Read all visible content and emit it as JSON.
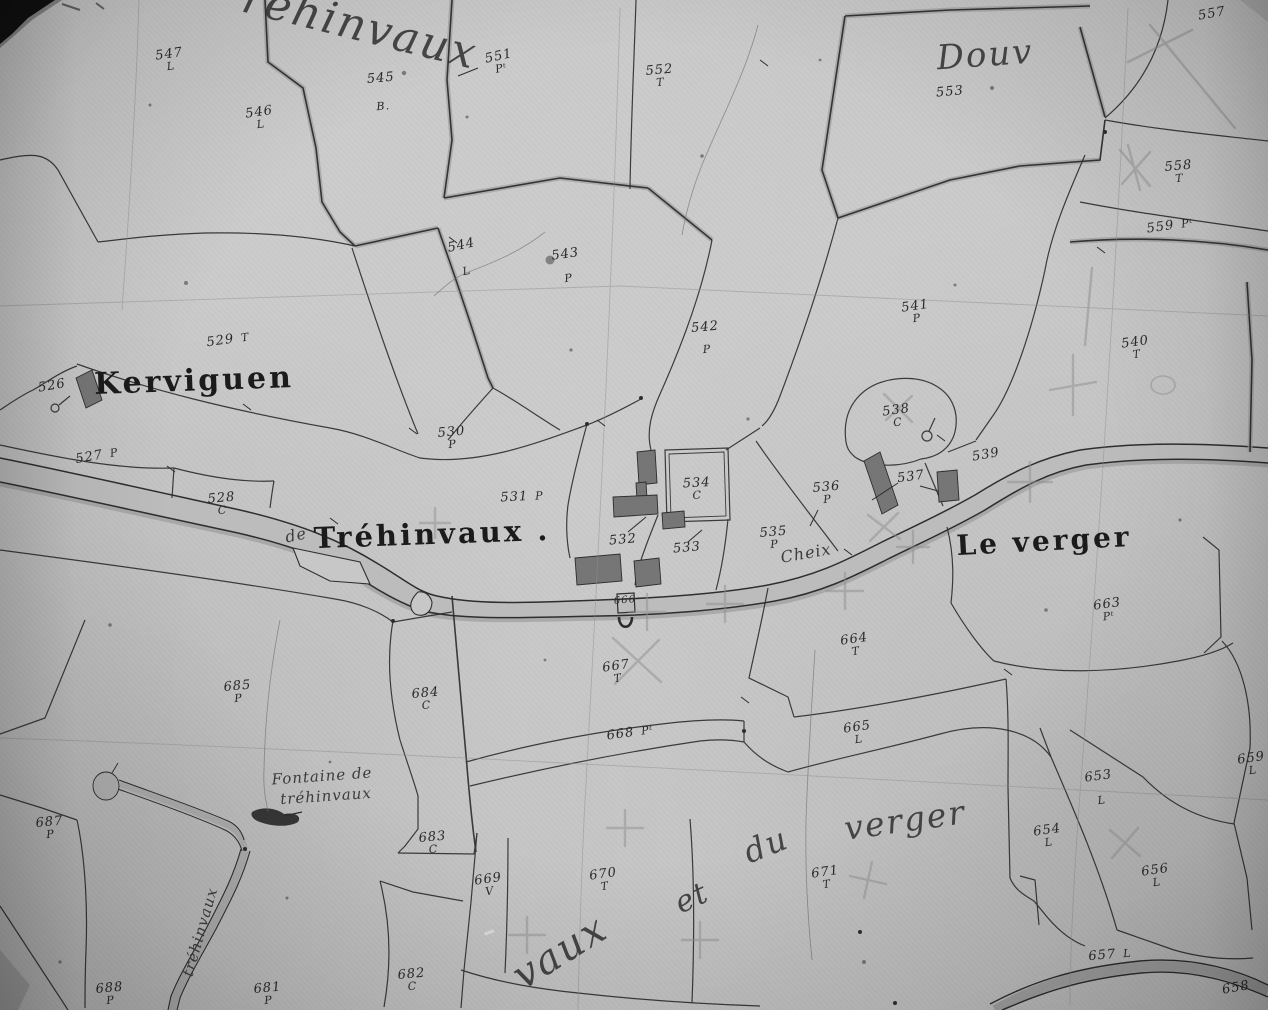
{
  "map": {
    "description_labels": {
      "type": "cadastral-map-scan"
    },
    "colors": {
      "paper": "#c7c7c7",
      "ink": "#2e2e2e",
      "boundary_shade": "#a2a2a2",
      "building_fill": "#767676",
      "road_fill": "#bcbcbc",
      "pencil": "#8f8f8f",
      "photo_corner": "#111111"
    },
    "places": [
      {
        "text": "Kerviguen",
        "x": 194,
        "y": 381,
        "size": 30,
        "rot": -2,
        "style": "bold"
      },
      {
        "text": "Tréhinvaux .",
        "x": 432,
        "y": 534,
        "size": 29,
        "rot": -2,
        "style": "bold"
      },
      {
        "text": "Le verger",
        "x": 1044,
        "y": 541,
        "size": 28,
        "rot": -3,
        "style": "bold"
      },
      {
        "text": "Douv",
        "x": 985,
        "y": 55,
        "size": 34,
        "rot": -4,
        "style": "script-big"
      },
      {
        "text": "réhinvaux",
        "x": 360,
        "y": 26,
        "size": 44,
        "rot": 14,
        "style": "script-big"
      },
      {
        "text": "Cheix",
        "x": 806,
        "y": 553,
        "size": 16,
        "rot": -10,
        "style": "script"
      },
      {
        "text": "Fontaine de",
        "x": 322,
        "y": 776,
        "size": 15,
        "rot": -4,
        "style": "script"
      },
      {
        "text": "tréhinvaux",
        "x": 326,
        "y": 796,
        "size": 15,
        "rot": -4,
        "style": "script"
      },
      {
        "text": "de",
        "x": 296,
        "y": 535,
        "size": 16,
        "rot": -12,
        "style": "script"
      },
      {
        "text": "vaux",
        "x": 560,
        "y": 952,
        "size": 40,
        "rot": -32,
        "style": "script-big"
      },
      {
        "text": "et",
        "x": 692,
        "y": 898,
        "size": 30,
        "rot": -25,
        "style": "script-big"
      },
      {
        "text": "du",
        "x": 766,
        "y": 845,
        "size": 32,
        "rot": -22,
        "style": "script-big"
      },
      {
        "text": "verger",
        "x": 905,
        "y": 820,
        "size": 33,
        "rot": -8,
        "style": "script-big"
      },
      {
        "text": "tréhinvaux",
        "x": 200,
        "y": 932,
        "size": 15,
        "rot": -74,
        "style": "script"
      }
    ],
    "parcels": [
      {
        "num": "547",
        "cls": "L",
        "x": 170,
        "y": 60,
        "rot": -8
      },
      {
        "num": "546",
        "cls": "L",
        "x": 260,
        "y": 118,
        "rot": -8
      },
      {
        "num": "545",
        "cls": "B.",
        "x": 382,
        "y": 92,
        "rot": -5,
        "gap": 16
      },
      {
        "num": "551",
        "cls": "Pᵗ",
        "x": 500,
        "y": 62,
        "rot": -12
      },
      {
        "num": "552",
        "cls": "T",
        "x": 660,
        "y": 76,
        "rot": -5
      },
      {
        "num": "553",
        "cls": "",
        "x": 950,
        "y": 92,
        "rot": -5
      },
      {
        "num": "557",
        "cls": "",
        "x": 1212,
        "y": 14,
        "rot": -10
      },
      {
        "num": "558",
        "cls": "T",
        "x": 1179,
        "y": 172,
        "rot": -5
      },
      {
        "num": "559",
        "cls": "Pᵗ",
        "x": 1170,
        "y": 226,
        "rot": -8,
        "inline": true
      },
      {
        "num": "544",
        "cls": "L",
        "x": 464,
        "y": 258,
        "rot": -12,
        "gap": 14
      },
      {
        "num": "543",
        "cls": "P",
        "x": 567,
        "y": 266,
        "rot": -8,
        "gap": 12
      },
      {
        "num": "542",
        "cls": "P",
        "x": 706,
        "y": 338,
        "rot": -5,
        "gap": 10
      },
      {
        "num": "541",
        "cls": "P",
        "x": 916,
        "y": 312,
        "rot": -8
      },
      {
        "num": "540",
        "cls": "T",
        "x": 1136,
        "y": 348,
        "rot": -8
      },
      {
        "num": "529",
        "cls": "T",
        "x": 228,
        "y": 340,
        "rot": -8,
        "inline": true
      },
      {
        "num": "526",
        "cls": "",
        "x": 52,
        "y": 386,
        "rot": -10
      },
      {
        "num": "527",
        "cls": "P",
        "x": 97,
        "y": 456,
        "rot": -10,
        "inline": true
      },
      {
        "num": "528",
        "cls": "C",
        "x": 222,
        "y": 504,
        "rot": -5
      },
      {
        "num": "530",
        "cls": "P",
        "x": 452,
        "y": 438,
        "rot": -5
      },
      {
        "num": "531",
        "cls": "P",
        "x": 522,
        "y": 497,
        "rot": -3,
        "inline": true
      },
      {
        "num": "534",
        "cls": "C",
        "x": 697,
        "y": 489,
        "rot": -3
      },
      {
        "num": "532",
        "cls": "",
        "x": 623,
        "y": 540,
        "rot": -5
      },
      {
        "num": "533",
        "cls": "",
        "x": 687,
        "y": 548,
        "rot": -5
      },
      {
        "num": "536",
        "cls": "P",
        "x": 827,
        "y": 493,
        "rot": -5
      },
      {
        "num": "537",
        "cls": "",
        "x": 911,
        "y": 477,
        "rot": -8
      },
      {
        "num": "538",
        "cls": "C",
        "x": 897,
        "y": 416,
        "rot": -8
      },
      {
        "num": "539",
        "cls": "",
        "x": 986,
        "y": 455,
        "rot": -10
      },
      {
        "num": "535",
        "cls": "P",
        "x": 774,
        "y": 538,
        "rot": -5
      },
      {
        "num": "663",
        "cls": "Pᵗ",
        "x": 1108,
        "y": 610,
        "rot": -8
      },
      {
        "num": "666",
        "cls": "",
        "x": 625,
        "y": 601,
        "rot": -5,
        "small": true
      },
      {
        "num": "667",
        "cls": "T",
        "x": 617,
        "y": 672,
        "rot": -8
      },
      {
        "num": "664",
        "cls": "T",
        "x": 855,
        "y": 645,
        "rot": -8
      },
      {
        "num": "668",
        "cls": "Pᵗ",
        "x": 630,
        "y": 733,
        "rot": -8,
        "inline": true
      },
      {
        "num": "665",
        "cls": "L",
        "x": 858,
        "y": 733,
        "rot": -8
      },
      {
        "num": "685",
        "cls": "P",
        "x": 238,
        "y": 692,
        "rot": -5
      },
      {
        "num": "684",
        "cls": "C",
        "x": 426,
        "y": 699,
        "rot": -5
      },
      {
        "num": "687",
        "cls": "P",
        "x": 50,
        "y": 828,
        "rot": -5
      },
      {
        "num": "683",
        "cls": "C",
        "x": 433,
        "y": 843,
        "rot": -5
      },
      {
        "num": "669",
        "cls": "V",
        "x": 489,
        "y": 885,
        "rot": -8
      },
      {
        "num": "670",
        "cls": "T",
        "x": 604,
        "y": 880,
        "rot": -8
      },
      {
        "num": "671",
        "cls": "T",
        "x": 826,
        "y": 878,
        "rot": -8
      },
      {
        "num": "682",
        "cls": "C",
        "x": 412,
        "y": 980,
        "rot": -5
      },
      {
        "num": "681",
        "cls": "P",
        "x": 268,
        "y": 994,
        "rot": -5
      },
      {
        "num": "688",
        "cls": "P",
        "x": 110,
        "y": 994,
        "rot": -5
      },
      {
        "num": "653",
        "cls": "L",
        "x": 1100,
        "y": 788,
        "rot": -8,
        "gap": 12
      },
      {
        "num": "654",
        "cls": "L",
        "x": 1048,
        "y": 836,
        "rot": -8
      },
      {
        "num": "656",
        "cls": "L",
        "x": 1156,
        "y": 876,
        "rot": -8
      },
      {
        "num": "657",
        "cls": "L",
        "x": 1110,
        "y": 955,
        "rot": -5,
        "inline": true
      },
      {
        "num": "658",
        "cls": "",
        "x": 1236,
        "y": 988,
        "rot": -10
      },
      {
        "num": "659",
        "cls": "L",
        "x": 1252,
        "y": 764,
        "rot": -8
      }
    ],
    "symbols": [
      {
        "name": "well-symbol",
        "parcel": "666"
      },
      {
        "name": "well-symbol",
        "parcel": "538"
      },
      {
        "name": "pond-symbol"
      },
      {
        "name": "fountain-blot-symbol"
      },
      {
        "name": "building-symbol"
      },
      {
        "name": "photo-corner-mark"
      }
    ]
  }
}
